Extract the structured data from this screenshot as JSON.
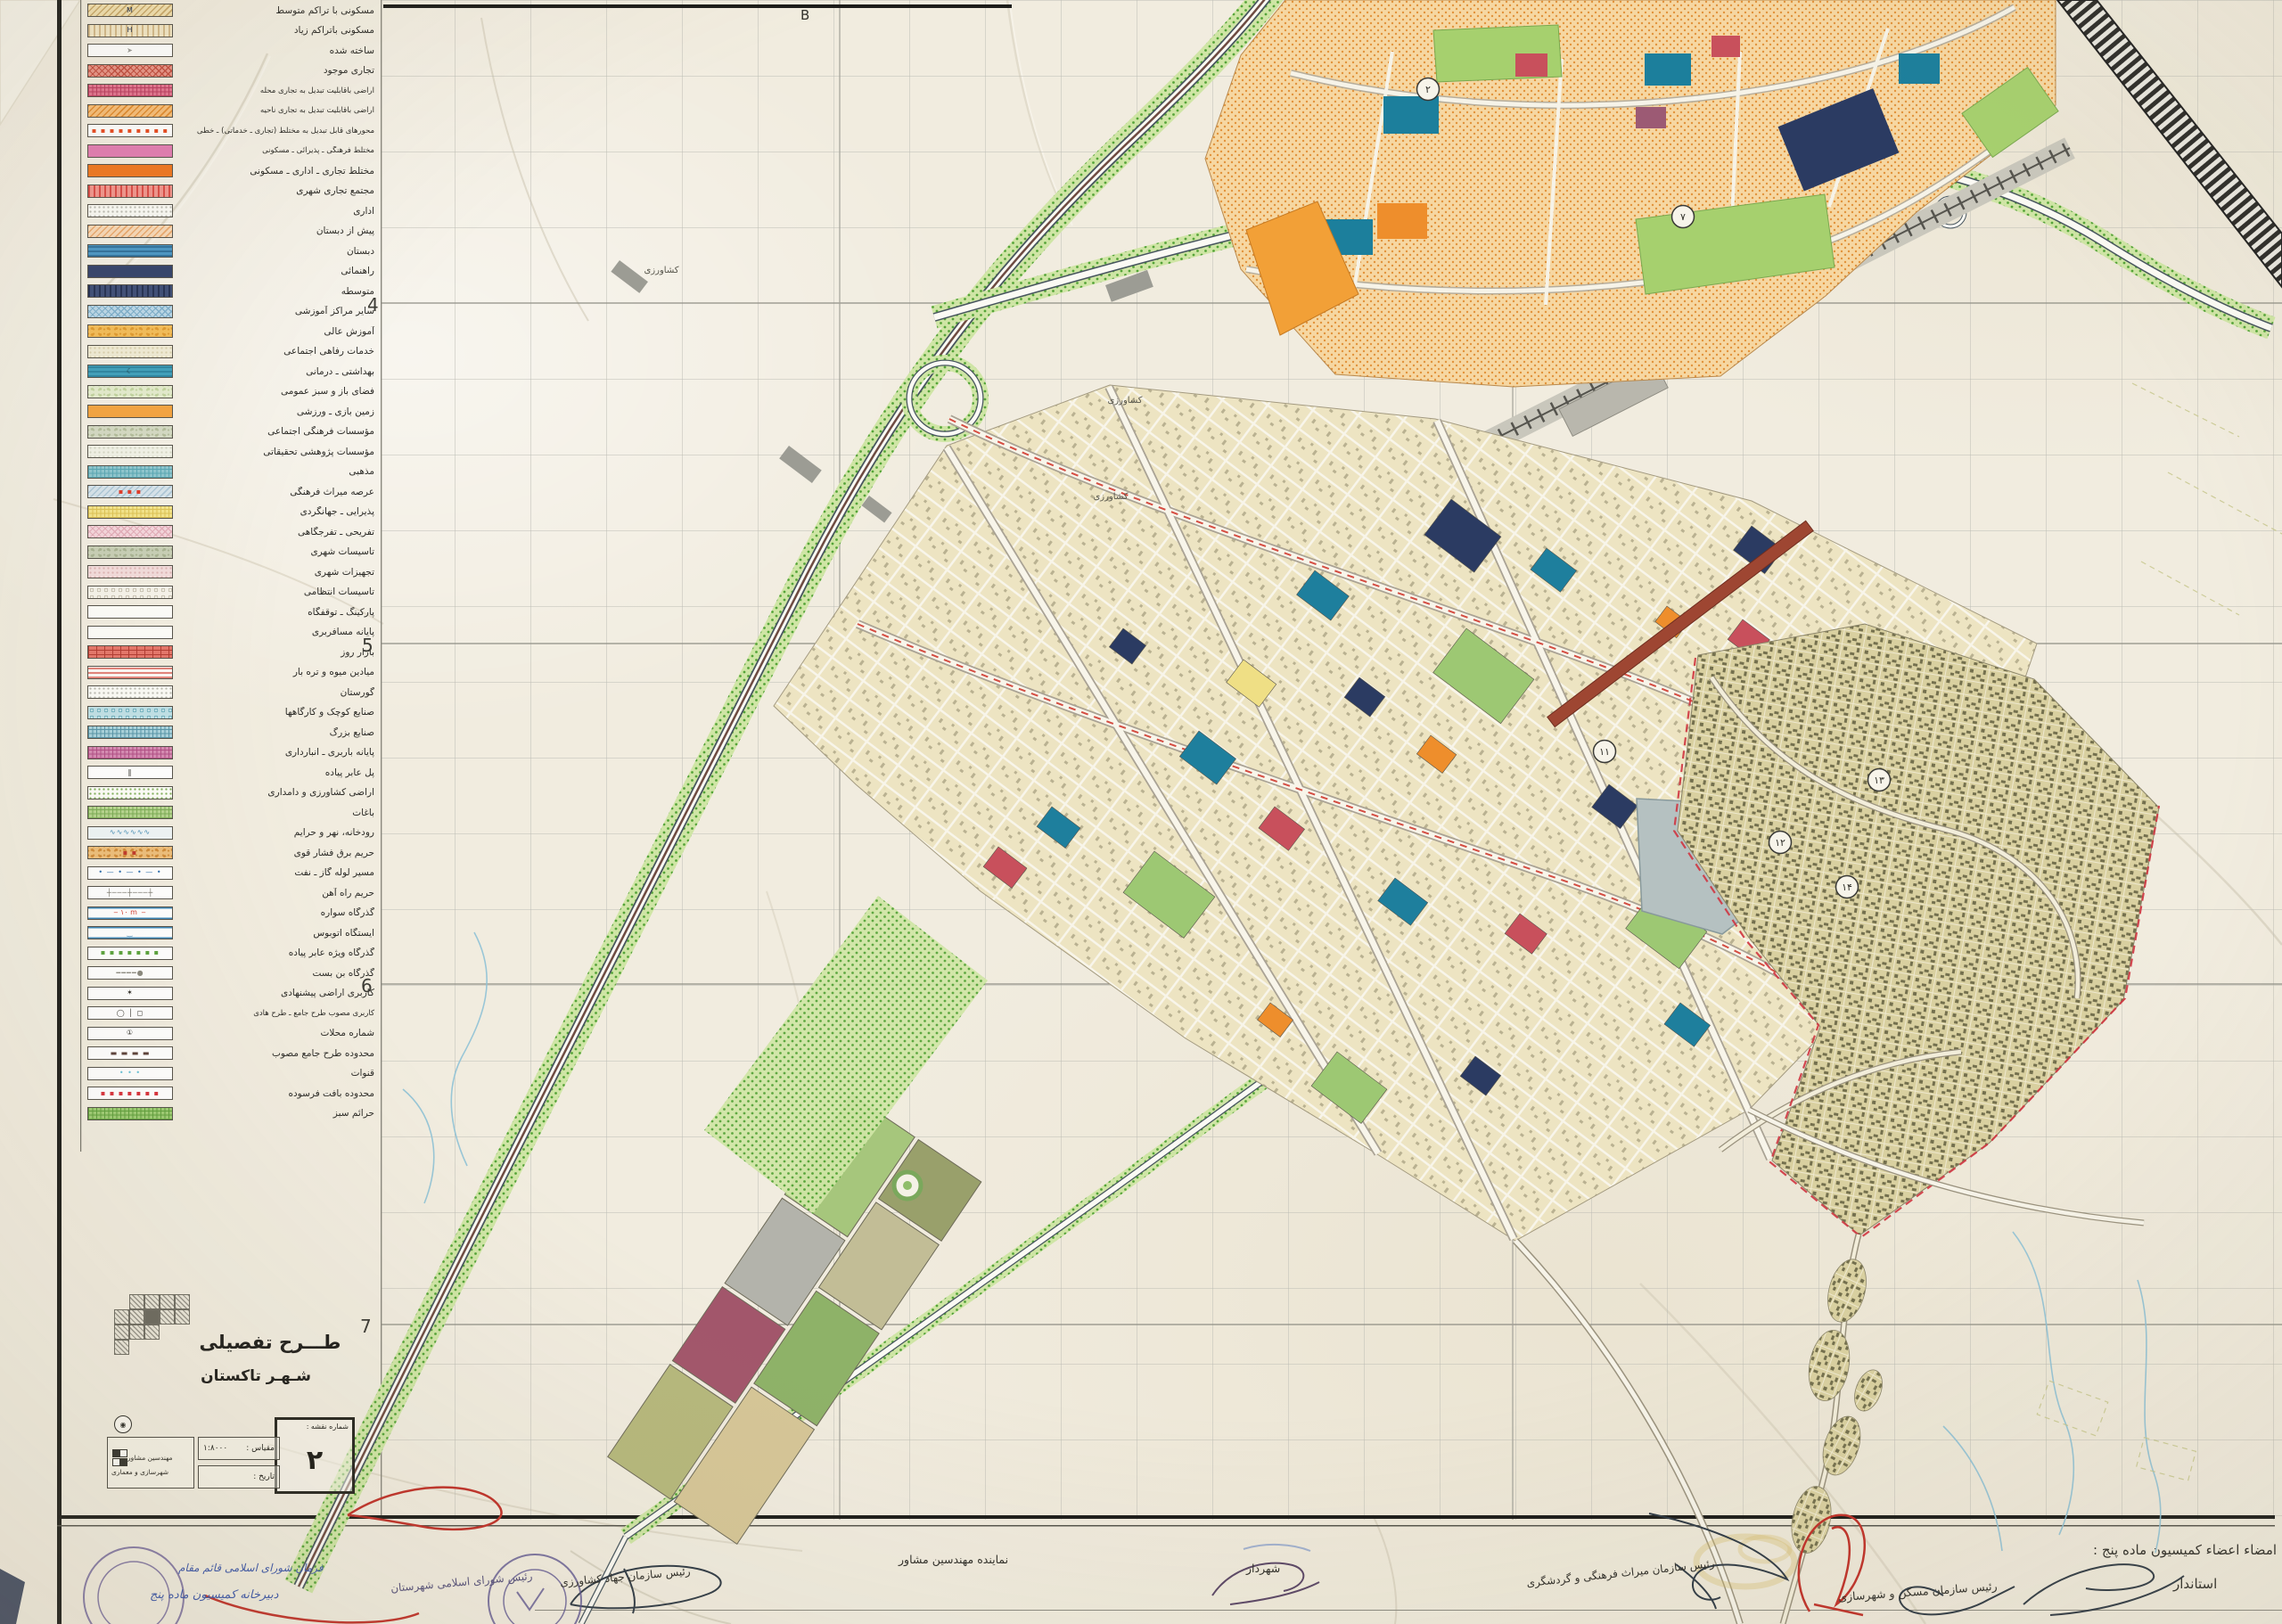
{
  "sheet": {
    "paper_color": "#f1ecdf",
    "grid_color": "#bcbcb4"
  },
  "title_block": {
    "title_line1": "طـــرح تفصیلی",
    "title_line2": "شـهـر تاکستان",
    "map_number_label": "شماره نقشه :",
    "map_number": "۲",
    "scale_label": "مقیاس :",
    "scale_value": "۱:۸۰۰۰",
    "date_label": "تاریخ :",
    "date_value": "",
    "consultant_line1": "مهندسین مشاور",
    "consultant_line2": "شهرسازی و معماری",
    "index_grid_rows": [
      "01111",
      "11211",
      "11100",
      "10000"
    ]
  },
  "grid_refs": {
    "rows": [
      "4",
      "5",
      "6",
      "7"
    ],
    "col_letter": "B"
  },
  "legend": {
    "items": [
      {
        "label": "مسکونی با تراکم متوسط",
        "bg": "#f1dfae",
        "pat": "d",
        "pc": "#c9a96a",
        "sym": "M",
        "sc": "#1c2b4a"
      },
      {
        "label": "مسکونی باتراکم زیاد",
        "bg": "#f3e7c6",
        "pat": "v",
        "pc": "#d3b98a",
        "sym": "H",
        "sc": "#1c2b4a"
      },
      {
        "label": "ساخته شده",
        "bg": "#ffffff",
        "pat": "none",
        "sym": "➤",
        "sc": "#9a9a96"
      },
      {
        "label": "تجاری موجود",
        "bg": "#e89487",
        "pat": "x",
        "pc": "#c24d3f"
      },
      {
        "label": "اراضی باقابلیت تبدیل به تجاری محله",
        "bg": "#e3738f",
        "pat": "g",
        "pc": "#b93a5e"
      },
      {
        "label": "اراضی باقابلیت تبدیل به تجاری ناحیه",
        "bg": "#f7bd77",
        "pat": "d",
        "pc": "#e08a2e"
      },
      {
        "label": "محورهای قابل تبدیل به مختلط (تجاری ـ خدماتی) ـ خطی",
        "bg": "#ffffff",
        "pat": "none",
        "sym": "▪ ▪ ▪ ▪ ▪ ▪ ▪ ▪ ▪",
        "sc": "#e8491f"
      },
      {
        "label": "مختلط فرهنگی ـ پذیرائی ـ مسکونی",
        "bg": "#e27cb2",
        "pat": "none"
      },
      {
        "label": "مختلط تجاری ـ اداری ـ مسکونی",
        "bg": "#f0761f",
        "pat": "none"
      },
      {
        "label": "مجتمع تجاری شهری",
        "bg": "#f2958d",
        "pat": "v",
        "pc": "#d94a45"
      },
      {
        "label": "اداری",
        "bg": "#fbfbf6",
        "pat": "dot",
        "pc": "#b9b9b0"
      },
      {
        "label": "پیش از دبستان",
        "bg": "#f8d9b8",
        "pat": "d",
        "pc": "#eaa96e"
      },
      {
        "label": "دبستان",
        "bg": "#4a97c6",
        "pat": "h",
        "pc": "#2f719c"
      },
      {
        "label": "راهنمائی",
        "bg": "#33426b",
        "pat": "none"
      },
      {
        "label": "متوسطه",
        "bg": "#3d4d77",
        "pat": "v",
        "pc": "#222f52"
      },
      {
        "label": "سایر مراکز آموزشی",
        "bg": "#bcd9ea",
        "pat": "x",
        "pc": "#7fb0cd"
      },
      {
        "label": "آموزش عالی",
        "bg": "#f4bd58",
        "pat": "m",
        "pc": "#e09a2f"
      },
      {
        "label": "خدمات رفاهی اجتماعی",
        "bg": "#f1ecd6",
        "pat": "dot",
        "pc": "#d9d0ae"
      },
      {
        "label": "بهداشتی ـ درمانی",
        "bg": "#3fa0bc",
        "pat": "h",
        "pc": "#2d86a2",
        "sym": "☾",
        "sc": "#15353f"
      },
      {
        "label": "فضای باز و سبز عمومی",
        "bg": "#e4ecce",
        "pat": "m",
        "pc": "#c2d4a0"
      },
      {
        "label": "زمین بازی ـ ورزشی",
        "bg": "#f5a440",
        "pat": "none"
      },
      {
        "label": "مؤسسات فرهنگی اجتماعی",
        "bg": "#d4dac4",
        "pat": "m",
        "pc": "#b3bd9c"
      },
      {
        "label": "مؤسسات پژوهشی تحقیقاتی",
        "bg": "#f2f3e8",
        "pat": "dot",
        "pc": "#d5d7c6"
      },
      {
        "label": "مذهبی",
        "bg": "#8ec6cf",
        "pat": "g",
        "pc": "#58a7b4"
      },
      {
        "label": "عرصه میراث فرهنگی",
        "bg": "#d7e4ec",
        "pat": "d",
        "pc": "#aec8d8",
        "sym": "▪ ▪ ▪",
        "sc": "#e03b2a"
      },
      {
        "label": "پذیرایی ـ جهانگردی",
        "bg": "#f4e48a",
        "pat": "g",
        "pc": "#ddc355"
      },
      {
        "label": "تفریحی ـ تفرجگاهی",
        "bg": "#f5d6dd",
        "pat": "x",
        "pc": "#e3aeba"
      },
      {
        "label": "تاسیسات شهری",
        "bg": "#c8cfb6",
        "pat": "m",
        "pc": "#a8b292"
      },
      {
        "label": "تجهیزات شهری",
        "bg": "#f3dcdc",
        "pat": "dot",
        "pc": "#dcb4b4"
      },
      {
        "label": "تاسیسات انتظامی",
        "bg": "#f6f3ea",
        "pat": "ring",
        "pc": "#b9b2a0"
      },
      {
        "label": "پارکینگ ـ توقفگاه",
        "bg": "#fdfdf9",
        "pat": "none"
      },
      {
        "label": "پایانه مسافربری",
        "bg": "#fdfdf9",
        "pat": "none"
      },
      {
        "label": "بازار روز",
        "bg": "#e4766a",
        "pat": "brick",
        "pc": "#b23c32"
      },
      {
        "label": "میادین میوه و تره بار",
        "bg": "#fcf7f4",
        "pat": "h",
        "pc": "#e2837a"
      },
      {
        "label": "گورستان",
        "bg": "#fbfbf6",
        "pat": "dot",
        "pc": "#b9b9b0"
      },
      {
        "label": "صنایع کوچک و کارگاهها",
        "bg": "#bfe0e6",
        "pat": "ring",
        "pc": "#5ba4b4"
      },
      {
        "label": "صنایع بزرگ",
        "bg": "#a9d2dc",
        "pat": "g",
        "pc": "#5795a8"
      },
      {
        "label": "پایانه باربری ـ انبارداری",
        "bg": "#d58ab2",
        "pat": "g",
        "pc": "#b14e85"
      },
      {
        "label": "پل عابر پیاده",
        "bg": "#ffffff",
        "pat": "none",
        "sym": "‖",
        "sc": "#33322c"
      },
      {
        "label": "اراضی کشاورزی و دامداری",
        "bg": "#fdfdf8",
        "pat": "dot",
        "pc": "#7fae5a"
      },
      {
        "label": "باغات",
        "bg": "#b5d48e",
        "pat": "g",
        "pc": "#7aab54"
      },
      {
        "label": "رودخانه، نهر و حرایم",
        "bg": "#eef4f6",
        "pat": "none",
        "sym": "∿∿∿∿∿∿",
        "sc": "#4a90b8"
      },
      {
        "label": "حریم برق فشار قوی",
        "bg": "#edbe7a",
        "pat": "m",
        "pc": "#d08c3a",
        "sym": "▪ ▪",
        "sc": "#c03a2a"
      },
      {
        "label": "مسیر لوله گاز ـ نفت",
        "bg": "#ffffff",
        "pat": "none",
        "sym": "• — • — • — •",
        "sc": "#2f6fae"
      },
      {
        "label": "حریم راه آهن",
        "bg": "#ffffff",
        "pat": "none",
        "sym": "┼───┼───┼",
        "sc": "#77756c"
      },
      {
        "label": "گذرگاه سواره",
        "bg": "#ffffff",
        "pat": "h2",
        "pc": "#3f88b8",
        "sym": "‒ ۱۰ m ‒",
        "sc": "#d23a2e"
      },
      {
        "label": "ایستگاه اتوبوس",
        "bg": "#ffffff",
        "pat": "h2",
        "pc": "#3f88b8",
        "sym": "‿",
        "sc": "#3f88b8"
      },
      {
        "label": "گذرگاه ویژه عابر پیاده",
        "bg": "#ffffff",
        "pat": "none",
        "sym": "▪ ▪ ▪ ▪ ▪ ▪ ▪",
        "sc": "#5aa23c"
      },
      {
        "label": "گذرگاه بن بست",
        "bg": "#ffffff",
        "pat": "none",
        "sym": "━━━━●",
        "sc": "#8a887e"
      },
      {
        "label": "کاربری اراضی پیشنهادی",
        "bg": "#ffffff",
        "pat": "none",
        "sym": "✶",
        "sc": "#2a2922"
      },
      {
        "label": "کاربری مصوب طرح جامع ـ طرح هادی",
        "bg": "#ffffff",
        "pat": "none",
        "sym": "◯ │ ◻",
        "sc": "#33322c"
      },
      {
        "label": "شماره محلات",
        "bg": "#ffffff",
        "pat": "none",
        "sym": "①",
        "sc": "#33322c"
      },
      {
        "label": "محدوده طرح جامع مصوب",
        "bg": "#ffffff",
        "pat": "none",
        "sym": "▬ ▬ ▬ ▬",
        "sc": "#5a3f38"
      },
      {
        "label": "قنوات",
        "bg": "#ffffff",
        "pat": "none",
        "sym": "•   •   •",
        "sc": "#69c2d8"
      },
      {
        "label": "محدوده بافت فرسوده",
        "bg": "#ffffff",
        "pat": "none",
        "sym": "▪ ▪ ▪ ▪ ▪ ▪ ▪",
        "sc": "#d8303a"
      },
      {
        "label": "حرائم سبز",
        "bg": "#9ccb72",
        "pat": "g",
        "pc": "#5f9e3c"
      }
    ]
  },
  "map": {
    "neighborhoods": [
      "۲",
      "۷",
      "۱۱",
      "۱۲",
      "۱۳",
      "۱۴"
    ],
    "annotations": [
      "کشاورزی",
      "کشاورزی",
      "کشاورزی"
    ],
    "colors": {
      "newtown": "#f6d7a2",
      "city_fabric": "#ede4c2",
      "old_fabric": "#d9d0a0",
      "green": "#cfe5a5",
      "water": "#b5c1c1",
      "freeway_green": "#a8cf7c"
    }
  },
  "signature_strip": {
    "commission_header": "امضاء اعضاء کمیسیون ماده پنج :",
    "roles": [
      "استاندار",
      "رئیس سازمان مسکن و شهرسازی",
      "رئیس سازمان میراث فرهنگی و گردشگری",
      "شهردار",
      "نماینده مهندسین مشاور",
      "رئیس سازمان جهاد کشاورزی",
      "رئیس شورای اسلامی شهرستان"
    ],
    "secretariat_note": "دبیرخانه کمیسیون ماده پنج",
    "handwriting_note": "فرمان شورای اسلامی قائم مقام"
  }
}
